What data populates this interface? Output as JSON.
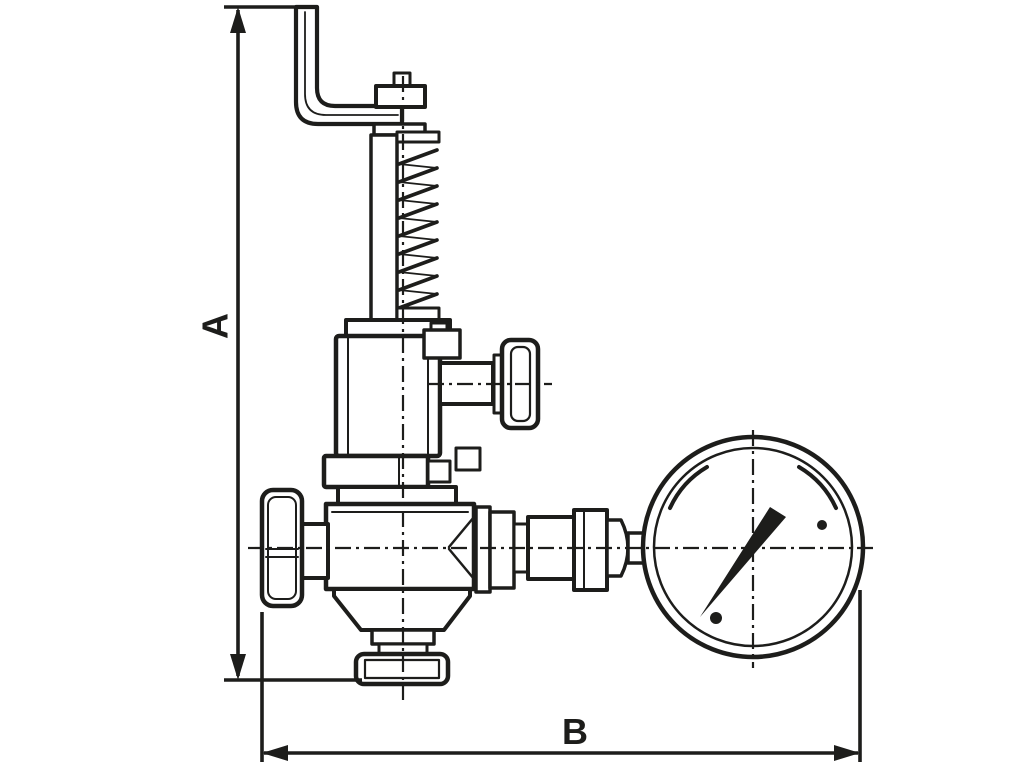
{
  "meta": {
    "background_color": "#ffffff",
    "ink_color": "#1d1d1b",
    "description": "Dimensioned technical line drawing of an overflow relief valve with bent lever, adjusting spring, side adjuster, handwheel, outlet flange and pressure gauge"
  },
  "dimensions": {
    "vertical_label": "A",
    "horizontal_label": "B"
  },
  "parts": [
    "bent-lever-arm",
    "adjusting-screw-cap",
    "spring-column",
    "yoke-bar",
    "spring-collar",
    "bonnet",
    "side-adjuster-shaft",
    "side-adjuster-knob",
    "mid-flange",
    "valve-body",
    "handwheel",
    "valve-stem",
    "outlet-cone",
    "outlet-flange",
    "gauge-fittings",
    "union-nut",
    "pressure-gauge",
    "gauge-needle",
    "gauge-screw-dots"
  ]
}
